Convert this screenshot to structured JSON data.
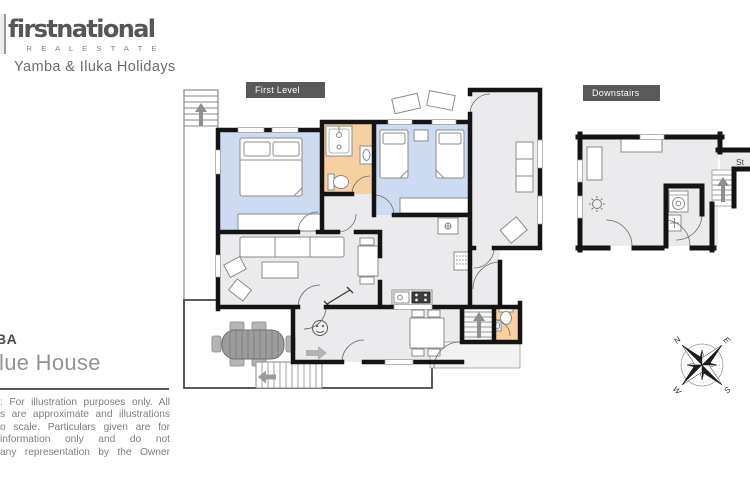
{
  "brand": {
    "name": "firstnational",
    "sub": "R E A L   E S T A T E",
    "tagline": "Yamba & Iluka Holidays"
  },
  "plan_labels": {
    "first_level": "First Level",
    "downstairs": "Downstairs"
  },
  "property": {
    "line1": "BA",
    "line2": "lue House"
  },
  "disclaimer": {
    "lines": [
      ": For illustration purposes only. All",
      "s are approximate and illustrations",
      "o scale. Particulars given are for",
      "information only and do not",
      "any representation by the Owner"
    ]
  },
  "downstairs_plan": {
    "edge_label": "St"
  },
  "compass": {
    "n": "N",
    "e": "E",
    "s": "S",
    "w": "W"
  },
  "icons": {
    "stairs_up_arrow": "↑",
    "stairs_down_arrow": "←",
    "entry_arrow": "→"
  },
  "colors": {
    "bedroom": "#ccdbf1",
    "bathroom": "#f6d0a0",
    "room": "#ebebed",
    "porch": "#f2f2f2",
    "wall": "#141414",
    "label_bg": "#58595b",
    "outdoor_table": "#9c9c9c"
  }
}
